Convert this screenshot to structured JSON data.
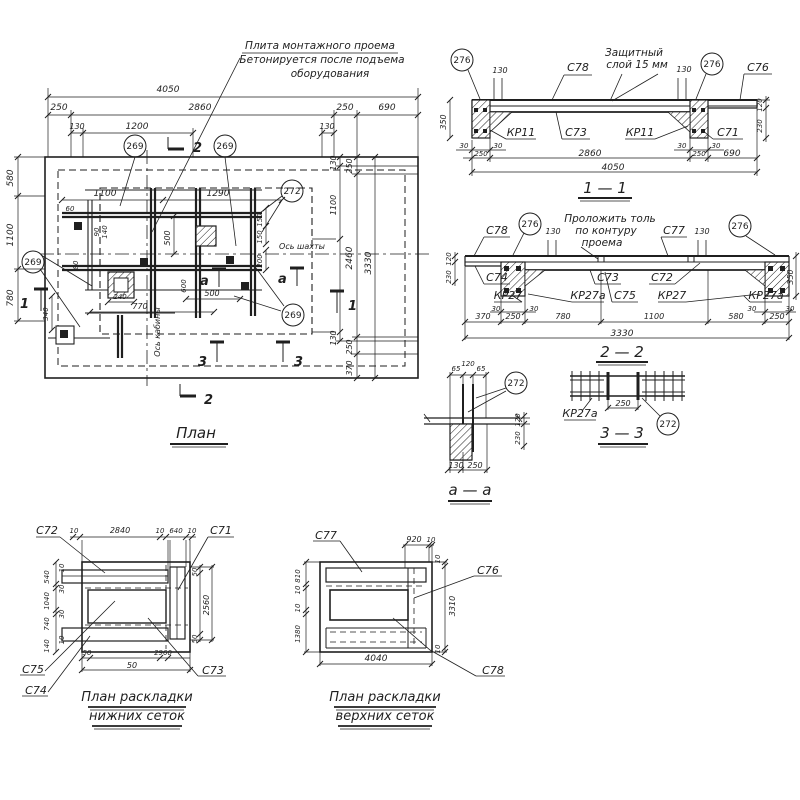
{
  "palette": {
    "ink": "#1f1f1f",
    "paper": "#ffffff"
  },
  "plan": {
    "title": "План",
    "note": [
      "Плита монтажного проема",
      "Бетонируется после подъема",
      "оборудования"
    ],
    "axis_shaft": "Ось шахты",
    "axis_cabin": "Ось кабины",
    "callout_269": "269",
    "callout_272": "272",
    "mark_1": "1",
    "mark_2": "2",
    "mark_3": "3",
    "mark_a": "а",
    "dims": {
      "total": "4050",
      "row1": [
        "250",
        "2860",
        "250",
        "690"
      ],
      "row2": [
        "130",
        "1200",
        "130"
      ],
      "left": [
        "580",
        "1100",
        "780"
      ],
      "right_a": [
        "130",
        "1100",
        "130"
      ],
      "right_b": [
        "250",
        "2460",
        "250",
        "370"
      ],
      "right_total": "3330",
      "in_1100": "1100",
      "in_1290": "1290",
      "in_500v": "500",
      "in_500h": "500",
      "in_770": "770",
      "in_240": "240",
      "in_340": "340",
      "in_60": "60",
      "in_90": "90",
      "in_140": "140",
      "in_80": "80",
      "in_150": "150",
      "in_200": "200",
      "in_600": "600"
    }
  },
  "s11": {
    "title": "1 — 1",
    "note": [
      "Защитный",
      "слой 15 мм"
    ],
    "callout": "276",
    "c78": "С78",
    "c76": "С76",
    "c73": "С73",
    "c71": "С71",
    "kp11": "КР11",
    "d130": "130",
    "d350": "350",
    "d30": "30",
    "d250": "250",
    "d2860": "2860",
    "d690": "690",
    "d4050": "4050",
    "d120": "120",
    "d230": "230"
  },
  "s22": {
    "title": "2 — 2",
    "note": [
      "Проложить толь",
      "по контуру",
      "проема"
    ],
    "callout": "276",
    "c78": "С78",
    "c77": "С77",
    "c74": "С74",
    "c73": "С73",
    "c72": "С72",
    "c75": "С75",
    "kp27": "КР27",
    "kp27a": "КР27а",
    "d130": "130",
    "d120": "120",
    "d230": "230",
    "d350": "350",
    "d30": "30",
    "row": [
      "370",
      "250",
      "780",
      "1100",
      "580",
      "250"
    ],
    "total": "3330"
  },
  "s33": {
    "title": "3 — 3",
    "kp27a": "КР27а",
    "d250": "250",
    "callout": "272"
  },
  "saa": {
    "title": "а — а",
    "callout": "272",
    "top": [
      "65",
      "120",
      "65"
    ],
    "right": [
      "120",
      "230"
    ],
    "bottom": [
      "130",
      "250"
    ]
  },
  "lower_mesh": {
    "title": [
      "План раскладки",
      "нижних сеток"
    ],
    "c72": "С72",
    "c71": "С71",
    "c75": "С75",
    "c74": "С74",
    "c73": "С73",
    "top": [
      "10",
      "2840",
      "10",
      "640",
      "10"
    ],
    "left": [
      "540",
      "10",
      "30",
      "1040",
      "30",
      "740",
      "10",
      "140"
    ],
    "right": [
      "50",
      "2560",
      "50"
    ],
    "bottom": [
      "50",
      "2960",
      "50"
    ]
  },
  "upper_mesh": {
    "title": [
      "План раскладки",
      "верхних сеток"
    ],
    "c77": "С77",
    "c76": "С76",
    "c78": "С78",
    "top": [
      "920",
      "10"
    ],
    "left": [
      "810",
      "10",
      "10",
      "1380"
    ],
    "right": [
      "10",
      "3310",
      "10"
    ],
    "bottom": "4040"
  }
}
